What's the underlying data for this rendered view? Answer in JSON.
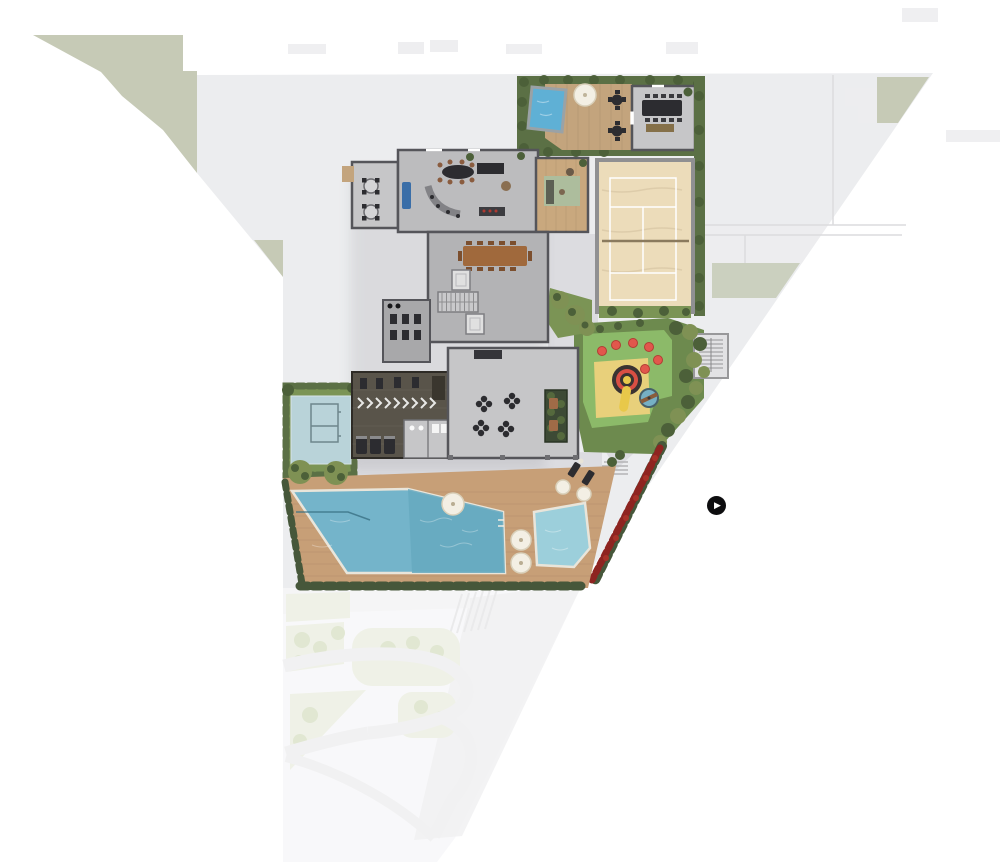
{
  "icons": {
    "play": "▶"
  },
  "colors": {
    "bg": "#ffffff",
    "context": "#f4f4f6",
    "neighbor": "#ededef",
    "road_fade": "#e7e7e9",
    "green_fade": "#e2e7d4",
    "tree_fade": "#c9d4ae",
    "sage": "#c6cab6",
    "plat": "#ecedef",
    "path_gray": "#dcdce0",
    "wall": "#55555a",
    "hedge": "#5b7045",
    "hedge_dark": "#46573a",
    "bush": "#4c6039",
    "lawn": "#7b9455",
    "lawn_dark": "#6d8a4e",
    "tree": "#7f9154",
    "sand": "#ecdcba",
    "sand_frame": "#909092",
    "line_white": "#ffffff",
    "net": "#8a7a5e",
    "court_blue": "#b9d3d9",
    "court_line": "#6e868c",
    "deck_wood": "#c79f77",
    "deck_top": "#c3a47d",
    "pool": "#74b4ca",
    "pool_dark": "#66a9c0",
    "kids_pool": "#9ccfdb",
    "spa": "#5fb0d5",
    "coping": "#e9e5da",
    "floor_main": "#bcbcbe",
    "floor_light": "#c6c6c8",
    "floor_mid": "#b3b3b5",
    "floor_dim": "#a8a8aa",
    "gym_floor": "#59544a",
    "wood_room": "#c9a87e",
    "rug": "#adbd9d",
    "wood_table": "#a0693c",
    "dark_furniture": "#2c2c30",
    "sofa_blue": "#3a6ea8",
    "leather": "#8a6f52",
    "play_green": "#8cba69",
    "play_yellow": "#e8d07b",
    "play_red": "#e2574c",
    "play_blue": "#76b0c4",
    "carousel_red": "#d94f43",
    "slide_yellow": "#e8c84a",
    "flower": "#8e2420",
    "umbrella": "#f3efe4",
    "umbrella_edge": "#d9d0ba",
    "planter": "#3d4a35",
    "stair_gray": "#e2e2e4",
    "play_button_bg": "#0d0d0f",
    "play_button_glyph": "#ffffff"
  }
}
